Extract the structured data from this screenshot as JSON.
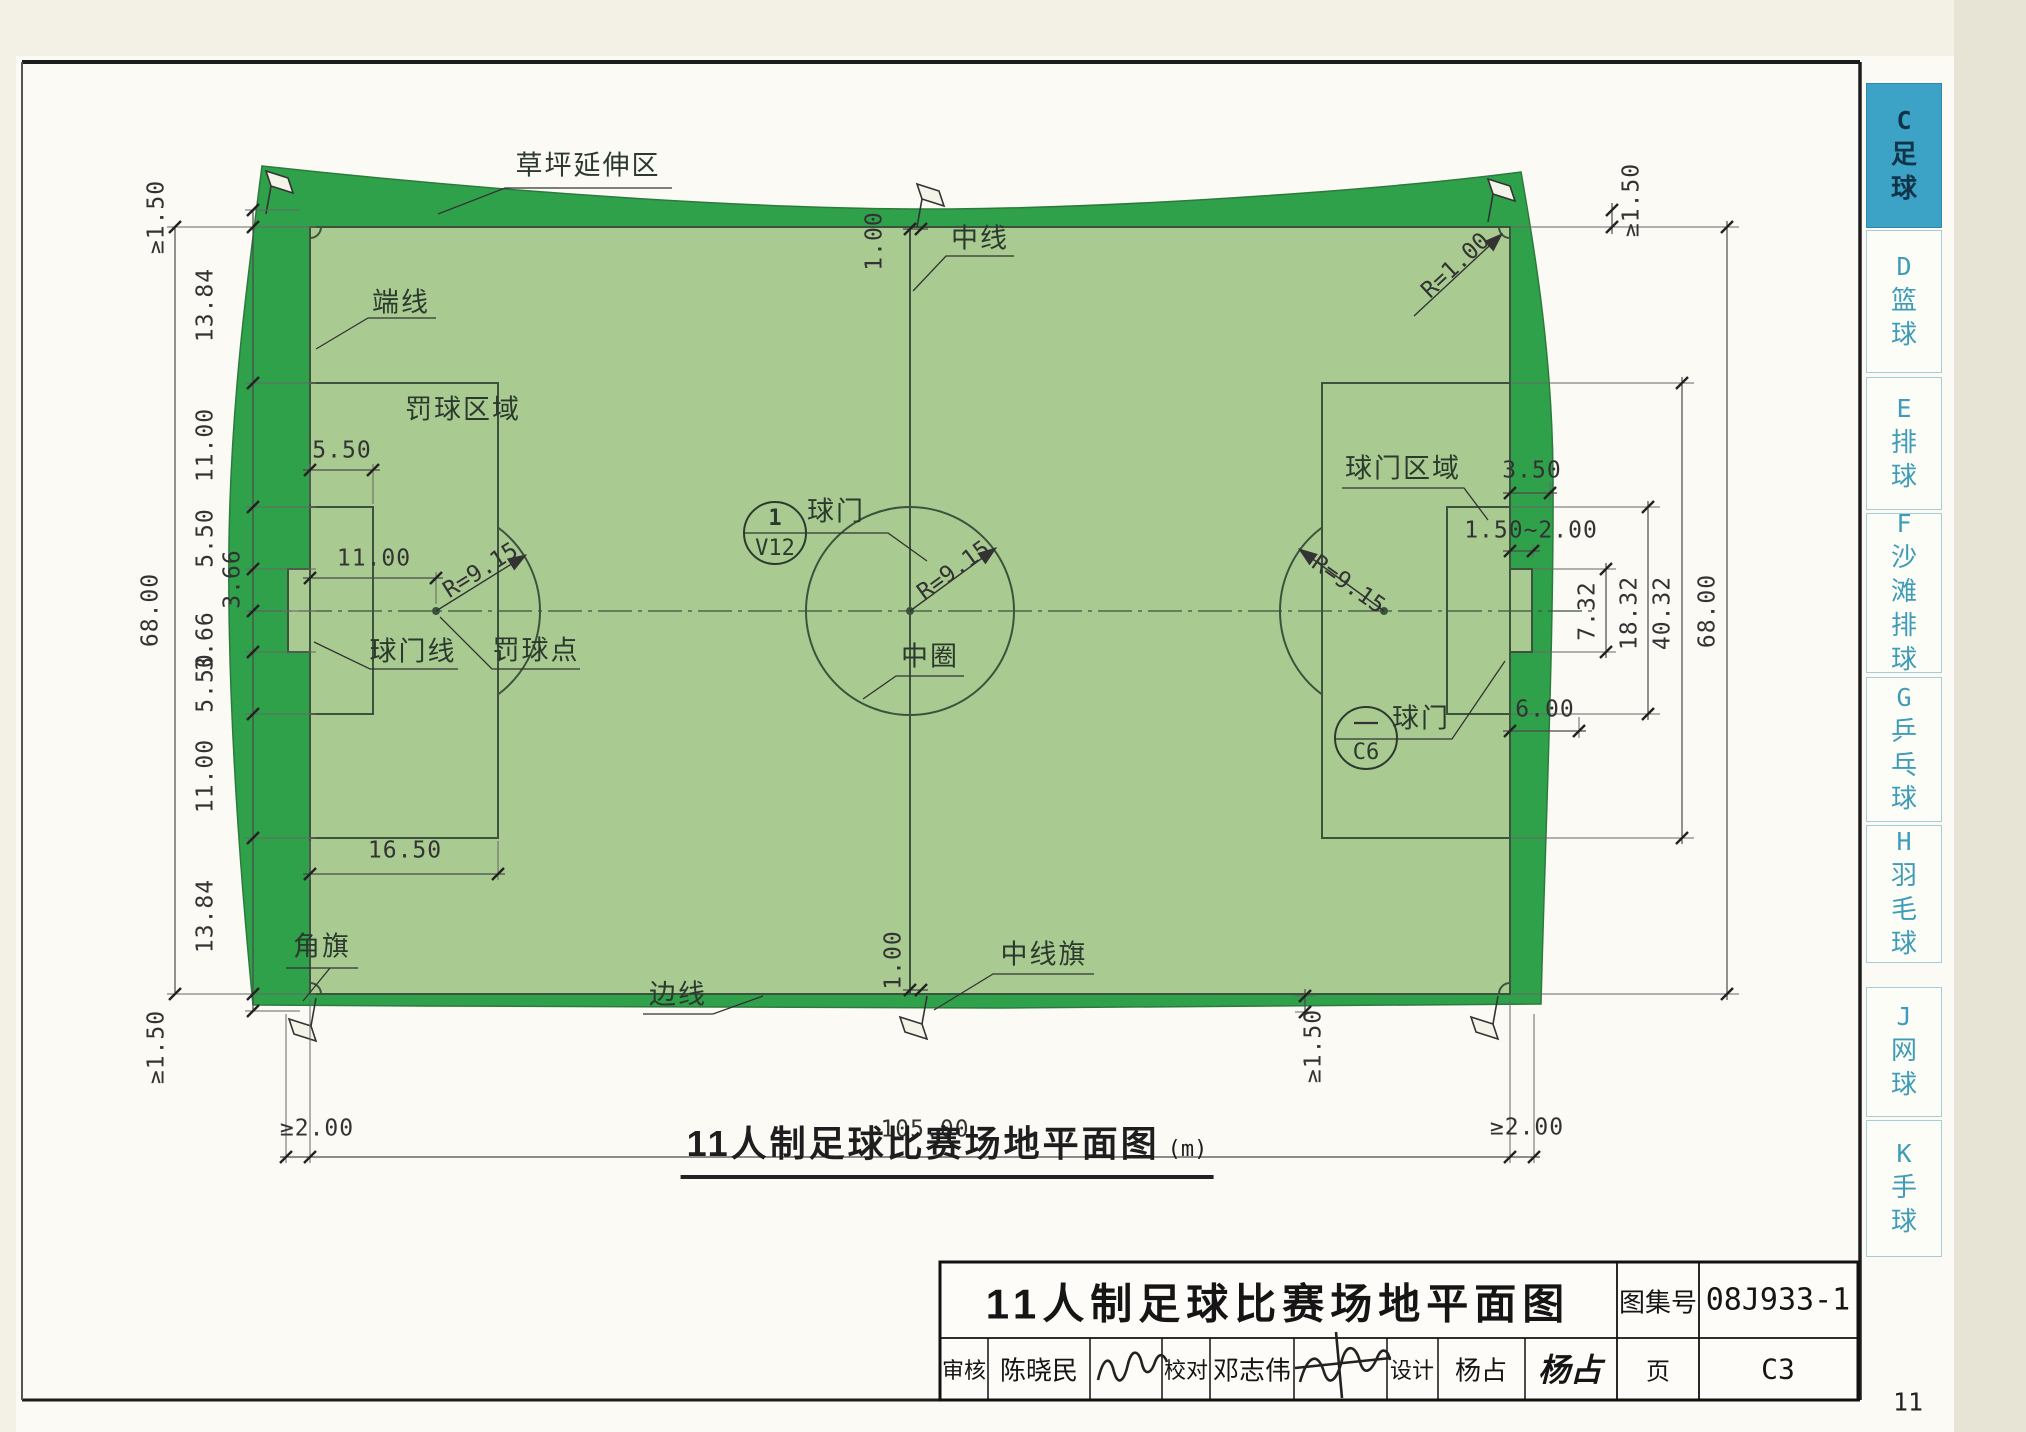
{
  "page": {
    "paper_no": "11"
  },
  "sidebar": {
    "tabs": [
      {
        "letter": "C",
        "label": "足球",
        "active": true
      },
      {
        "letter": "D",
        "label": "篮球",
        "active": false
      },
      {
        "letter": "E",
        "label": "排球",
        "active": false
      },
      {
        "letter": "F",
        "label": "沙滩排球",
        "active": false
      },
      {
        "letter": "G",
        "label": "乒乓球",
        "active": false
      },
      {
        "letter": "H",
        "label": "羽毛球",
        "active": false
      },
      {
        "letter": "J",
        "label": "网球",
        "active": false
      },
      {
        "letter": "K",
        "label": "手球",
        "active": false
      }
    ]
  },
  "caption": {
    "text": "11人制足球比赛场地平面图",
    "unit": "(m)"
  },
  "title_block": {
    "title": "11人制足球比赛场地平面图",
    "atlas_label": "图集号",
    "atlas_no": "08J933-1",
    "page_label": "页",
    "page_no": "C3",
    "review_label": "审核",
    "reviewer": "陈晓民",
    "proof_label": "校对",
    "proofreader": "邓志伟",
    "design_label": "设计",
    "designer": "杨占",
    "designer_signature": "杨占"
  },
  "labels": {
    "lawn_extension": "草坪延伸区",
    "end_line": "端线",
    "penalty_area": "罚球区域",
    "goal_line": "球门线",
    "penalty_spot": "罚球点",
    "center_line": "中线",
    "center_circle": "中圈",
    "goal": "球门",
    "goal_area": "球门区域",
    "corner_flag": "角旗",
    "side_line": "边线",
    "center_line_flag": "中线旗"
  },
  "detail_refs": {
    "left": {
      "num": "1",
      "sheet": "V12"
    },
    "right": {
      "sheet": "C6"
    }
  },
  "dims": {
    "ge150": "≥1.50",
    "ge200": "≥2.00",
    "field_length": "105.00",
    "field_width": "68.00",
    "chain": [
      "13.84",
      "11.00",
      "5.50",
      "3.66",
      "3.66",
      "5.50",
      "11.00",
      "13.84"
    ],
    "goal_area_depth": "5.50",
    "penalty_dist": "11.00",
    "penalty_depth": "16.50",
    "r_915": "R=9.15",
    "r_100": "R=1.00",
    "flag_offset": "1.00",
    "d_350": "3.50",
    "d_150_200": "1.50~2.00",
    "goal_width": "7.32",
    "goal_area_width": "18.32",
    "penalty_width": "40.32",
    "d_600": "6.00"
  },
  "colors": {
    "lawn_dark": "#2fa14b",
    "lawn_light": "#a9cb92",
    "tab_active": "#3da3c6",
    "field_line": "#3c523c"
  }
}
